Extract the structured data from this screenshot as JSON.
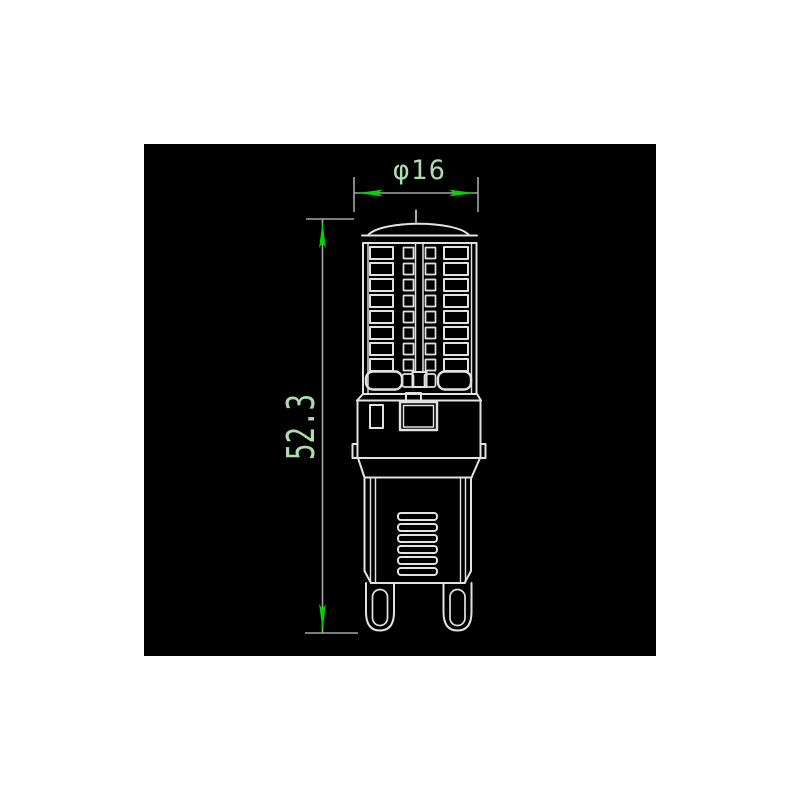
{
  "page": {
    "background": "#ffffff"
  },
  "canvas": {
    "background": "#000000"
  },
  "colors": {
    "outline": "#e2e2e2",
    "dimension_line": "#9fa89f",
    "arrow": "#00d400",
    "dimension_text": "#aedcae"
  },
  "dimensions": {
    "diameter": {
      "label": "φ16"
    },
    "height": {
      "label": "52.3"
    }
  }
}
